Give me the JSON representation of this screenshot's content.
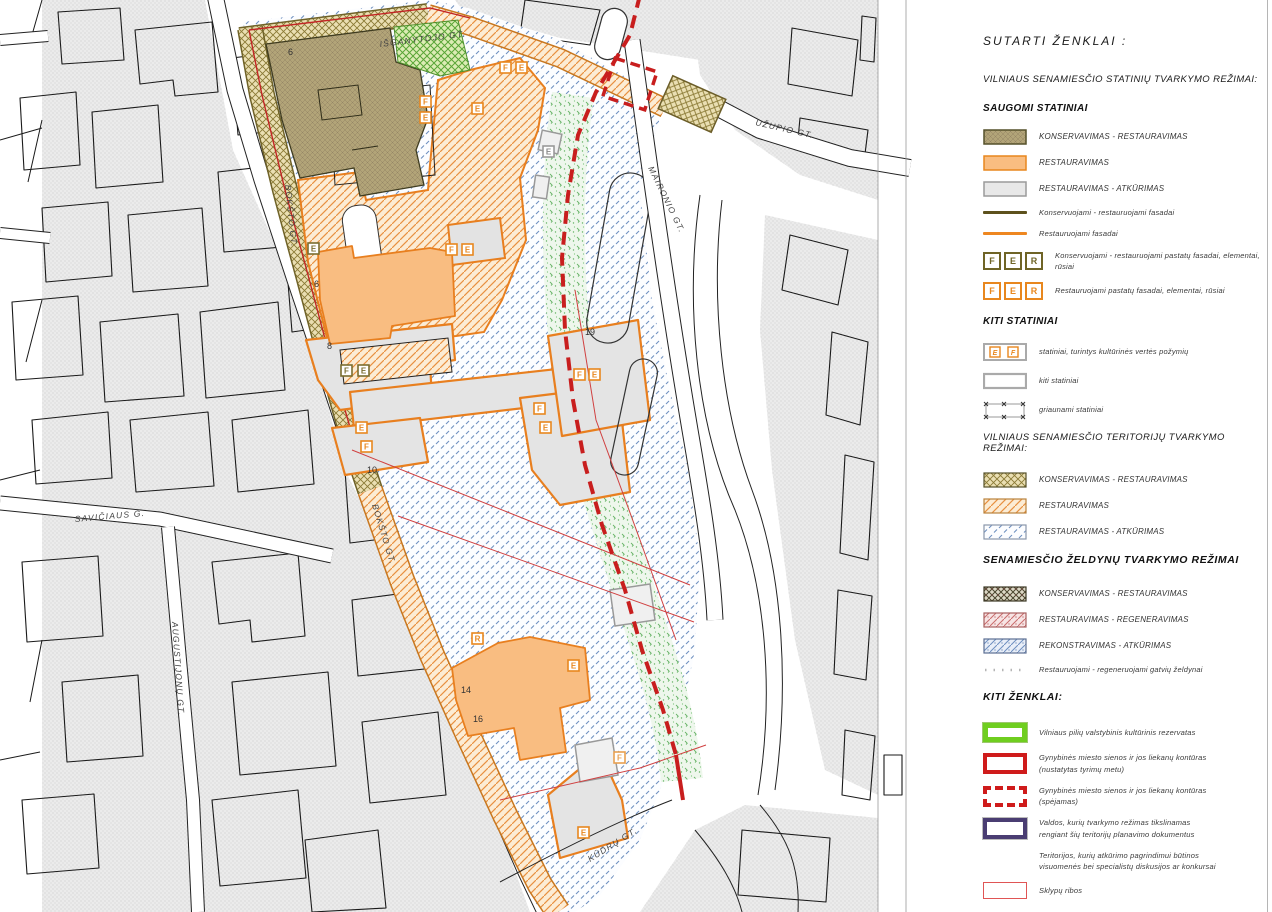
{
  "map": {
    "street_labels": [
      "IŠGANYTOJO GT.",
      "BOKŠTO GT.",
      "BOKŠTO GT.",
      "UŽUPIO GT.",
      "MAIRONIO GT.",
      "SAVIČIAUS G.",
      "AUGUSTIJONŲ GT.",
      "KŪDRŲ GT."
    ],
    "numbers": [
      "6",
      "6",
      "8",
      "10",
      "19",
      "14",
      "16"
    ],
    "markers": [
      "F",
      "E",
      "E",
      "F",
      "E",
      "E",
      "F",
      "E",
      "F",
      "E",
      "E",
      "F",
      "F",
      "E",
      "F",
      "E",
      "E",
      "R",
      "E",
      "F",
      "E"
    ]
  },
  "legend": {
    "title": "SUTARTI  ŽENKLAI :",
    "buildings": {
      "heading": "VILNIAUS SENAMIESČIO STATINIŲ TVARKYMO REŽIMAI:",
      "subheading": "SAUGOMI STATINIAI",
      "items": [
        "KONSERVAVIMAS - RESTAURAVIMAS",
        "RESTAURAVIMAS",
        "RESTAURAVIMAS - ATKŪRIMAS",
        "Konservuojami - restauruojami fasadai",
        "Restauruojami fasadai",
        "Konservuojami - restauruojami pastatų fasadai, elementai, rūsiai",
        "Restauruojami pastatų fasadai, elementai, rūsiai"
      ],
      "other_heading": "KITI STATINIAI",
      "other_items": [
        "statiniai,  turintys kultūrinės vertės požymių",
        "kiti statiniai",
        "griaunami statiniai"
      ]
    },
    "territories": {
      "heading": "VILNIAUS SENAMIESČIO TERITORIJŲ TVARKYMO REŽIMAI:",
      "items": [
        "KONSERVAVIMAS - RESTAURAVIMAS",
        "RESTAURAVIMAS",
        "RESTAURAVIMAS - ATKŪRIMAS"
      ]
    },
    "greenery": {
      "heading": "SENAMIESČIO ŽELDYNŲ TVARKYMO REŽIMAI",
      "items": [
        "KONSERVAVIMAS - RESTAURAVIMAS",
        "RESTAURAVIMAS - REGENERAVIMAS",
        "REKONSTRAVIMAS - ATKŪRIMAS",
        "Restauruojami - regeneruojami gatvių želdynai"
      ]
    },
    "other": {
      "heading": "KITI ŽENKLAI:",
      "items": [
        {
          "l1": "Vilniaus pilių valstybinis kultūrinis rezervatas",
          "l2": ""
        },
        {
          "l1": "Gynybinės miesto sienos ir jos liekanų kontūras",
          "l2": "(nustatytas tyrimų metu)"
        },
        {
          "l1": "Gynybinės miesto sienos ir jos liekanų kontūras",
          "l2": "(spėjamas)"
        },
        {
          "l1": "Valdos, kurių tvarkymo režimas tikslinamas",
          "l2": "rengiant šių teritorijų planavimo dokumentus"
        },
        {
          "l1": "Teritorijos, kurių atkūrimo pagrindimui būtinos",
          "l2": "visuomenės bei specialistų diskusijos ar konkursai"
        },
        {
          "l1": "Sklypų ribos",
          "l2": ""
        }
      ]
    },
    "fer": [
      "F",
      "E",
      "R"
    ],
    "ef": [
      "E",
      "F"
    ]
  },
  "colors": {
    "accent_orange": "#e8871e",
    "building_orange": "#f9bd81",
    "olive_building": "#b0a478",
    "olive_dark": "#6f6426",
    "blue_hatch": "#6d8fc0",
    "green_speckle": "#66b366",
    "green_reserve": "#6fce1f",
    "red_wall": "#c81e1e",
    "purple": "#4a3d72",
    "parcel_red": "#d04040",
    "gray_building": "#e4e4e4"
  }
}
